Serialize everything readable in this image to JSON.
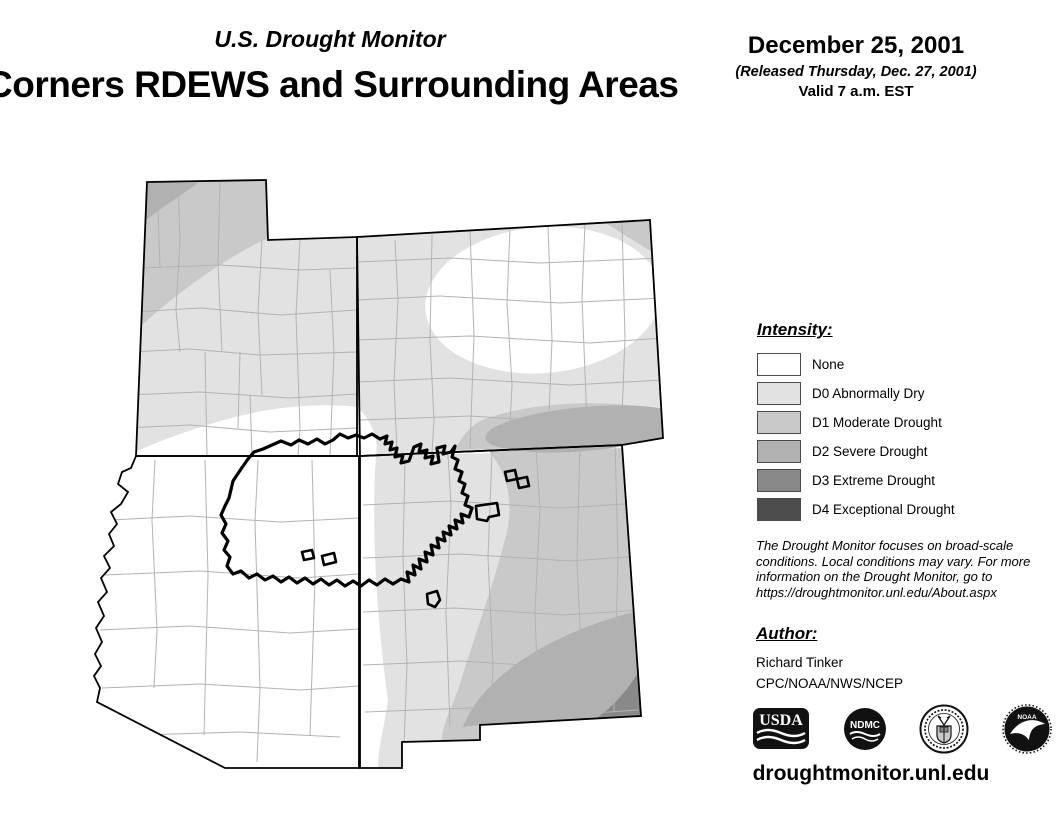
{
  "header": {
    "monitor_title": "U.S. Drought Monitor",
    "region_title": "Corners RDEWS and Surrounding Areas",
    "date": "December 25, 2001",
    "released": "(Released Thursday, Dec. 27, 2001)",
    "valid": "Valid 7 a.m. EST"
  },
  "legend": {
    "title": "Intensity:",
    "items": [
      {
        "label": "None",
        "color": "#ffffff"
      },
      {
        "label": "D0 Abnormally Dry",
        "color": "#e2e2e2"
      },
      {
        "label": "D1 Moderate Drought",
        "color": "#c9c9c9"
      },
      {
        "label": "D2 Severe Drought",
        "color": "#b1b1b1"
      },
      {
        "label": "D3 Extreme Drought",
        "color": "#898989"
      },
      {
        "label": "D4 Exceptional Drought",
        "color": "#4d4d4d"
      }
    ]
  },
  "disclaimer": {
    "lines": [
      "The Drought Monitor focuses on broad-scale",
      "conditions. Local conditions may vary. For more",
      "information on the Drought Monitor, go to",
      "https://droughtmonitor.unl.edu/About.aspx"
    ]
  },
  "author": {
    "title": "Author:",
    "name": "Richard Tinker",
    "org": "CPC/NOAA/NWS/NCEP"
  },
  "footer": {
    "url": "droughtmonitor.unl.edu",
    "logos": [
      {
        "name": "usda-logo",
        "text": "USDA"
      },
      {
        "name": "ndmc-logo",
        "text": "NDMC"
      },
      {
        "name": "commerce-seal",
        "text": ""
      },
      {
        "name": "noaa-logo",
        "text": "NOAA"
      }
    ]
  }
}
